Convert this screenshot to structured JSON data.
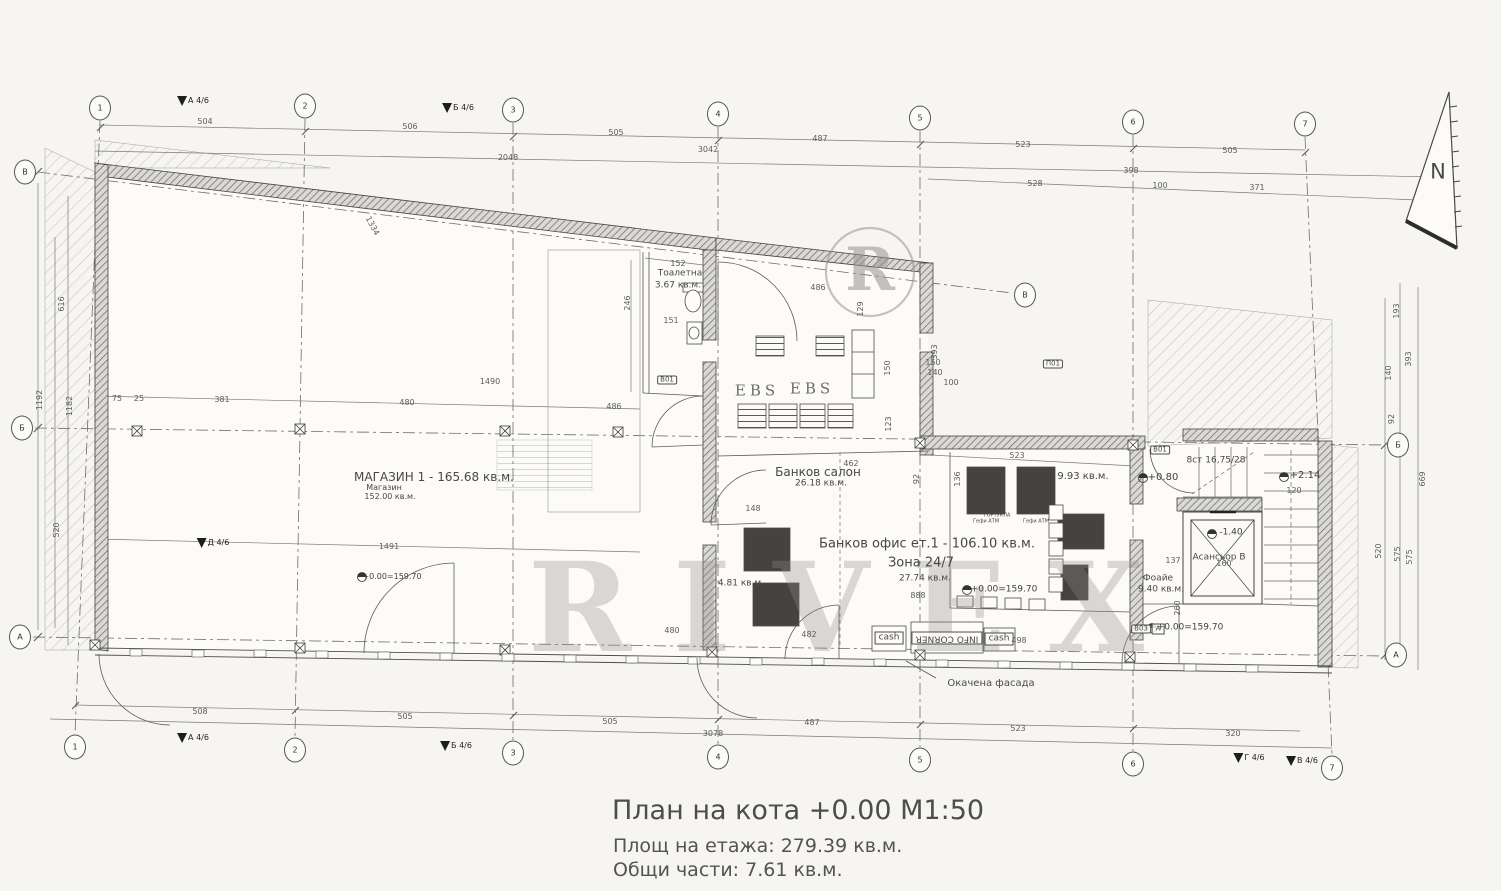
{
  "title": {
    "main": "План на кота +0.00 М1:50",
    "line1": "Площ на етажа: 279.39 кв.м.",
    "line2": "Общи части: 7.61 кв.м."
  },
  "watermark": {
    "big": "RIVEX",
    "circle": "R"
  },
  "colors": {
    "paper": "#f6f5f1",
    "ink": "#4a4a4a",
    "wall_fill": "#d9d7d1",
    "dark_block": "#454240",
    "watermark": "#8f8d87"
  },
  "grid": {
    "bubbles": [
      {
        "n": "grid-bubble-top-1",
        "t": "1",
        "x": 100,
        "y": 108
      },
      {
        "n": "grid-bubble-top-2",
        "t": "2",
        "x": 305,
        "y": 106
      },
      {
        "n": "grid-bubble-top-3",
        "t": "3",
        "x": 513,
        "y": 110
      },
      {
        "n": "grid-bubble-top-4",
        "t": "4",
        "x": 718,
        "y": 114
      },
      {
        "n": "grid-bubble-top-5",
        "t": "5",
        "x": 920,
        "y": 118
      },
      {
        "n": "grid-bubble-top-6",
        "t": "6",
        "x": 1133,
        "y": 122
      },
      {
        "n": "grid-bubble-top-7",
        "t": "7",
        "x": 1305,
        "y": 124
      },
      {
        "n": "grid-bubble-bottom-1",
        "t": "1",
        "x": 75,
        "y": 747
      },
      {
        "n": "grid-bubble-bottom-2",
        "t": "2",
        "x": 295,
        "y": 750
      },
      {
        "n": "grid-bubble-bottom-3",
        "t": "3",
        "x": 513,
        "y": 753
      },
      {
        "n": "grid-bubble-bottom-4",
        "t": "4",
        "x": 718,
        "y": 757
      },
      {
        "n": "grid-bubble-bottom-5",
        "t": "5",
        "x": 920,
        "y": 760
      },
      {
        "n": "grid-bubble-bottom-6",
        "t": "6",
        "x": 1133,
        "y": 764
      },
      {
        "n": "grid-bubble-bottom-7",
        "t": "7",
        "x": 1332,
        "y": 768
      },
      {
        "n": "grid-bubble-left-v",
        "t": "В",
        "x": 25,
        "y": 172
      },
      {
        "n": "grid-bubble-left-b",
        "t": "Б",
        "x": 22,
        "y": 428
      },
      {
        "n": "grid-bubble-left-a",
        "t": "А",
        "x": 20,
        "y": 637
      },
      {
        "n": "grid-bubble-right-b",
        "t": "Б",
        "x": 1398,
        "y": 445
      },
      {
        "n": "grid-bubble-right-a",
        "t": "А",
        "x": 1396,
        "y": 655
      },
      {
        "n": "grid-bubble-mid-v",
        "t": "В",
        "x": 1025,
        "y": 295
      }
    ],
    "flags": [
      {
        "n": "section-flag",
        "t": "А 4/6",
        "x": 193,
        "y": 101
      },
      {
        "n": "section-flag",
        "t": "Б 4/6",
        "x": 458,
        "y": 108
      },
      {
        "n": "section-flag",
        "t": "А 4/6",
        "x": 193,
        "y": 738
      },
      {
        "n": "section-flag",
        "t": "Б 4/6",
        "x": 456,
        "y": 746
      },
      {
        "n": "section-flag",
        "t": "Г 4/6",
        "x": 1249,
        "y": 758
      },
      {
        "n": "section-flag",
        "t": "В 4/6",
        "x": 1302,
        "y": 761
      },
      {
        "n": "section-flag",
        "t": "Д 4/6",
        "x": 213,
        "y": 543
      }
    ]
  },
  "rooms": [
    {
      "n": "room-label-shop",
      "t": "МАГАЗИН 1 - 165.68 кв.м.",
      "x": 434,
      "y": 477,
      "s": 12
    },
    {
      "n": "room-label-shop-sub",
      "t": "Магазин",
      "x": 384,
      "y": 488,
      "s": 8
    },
    {
      "n": "room-label-shop-area",
      "t": "152.00 кв.м.",
      "x": 390,
      "y": 497,
      "s": 8
    },
    {
      "n": "room-label-toilet",
      "t": "Тоалетна",
      "x": 680,
      "y": 274,
      "s": 9
    },
    {
      "n": "room-label-toilet-area",
      "t": "3.67 кв.м.",
      "x": 678,
      "y": 286,
      "s": 9
    },
    {
      "n": "room-label-bank-salon",
      "t": "Банков салон",
      "x": 818,
      "y": 472,
      "s": 12
    },
    {
      "n": "room-label-bank-salon-area",
      "t": "26.18 кв.м.",
      "x": 821,
      "y": 484,
      "s": 9
    },
    {
      "n": "room-label-bank-office",
      "t": "Банков офис ет.1 - 106.10 кв.м.",
      "x": 927,
      "y": 544,
      "s": 13
    },
    {
      "n": "room-label-zone-247",
      "t": "Зона 24/7",
      "x": 921,
      "y": 563,
      "s": 13
    },
    {
      "n": "room-label-zone-247-area",
      "t": "27.74 кв.м.",
      "x": 925,
      "y": 579,
      "s": 9
    },
    {
      "n": "room-label-atm-room-area",
      "t": "9.93 кв.м.",
      "x": 1083,
      "y": 477,
      "s": 10
    },
    {
      "n": "room-label-small-area",
      "t": "4.81 кв.м.",
      "x": 741,
      "y": 584,
      "s": 9
    },
    {
      "n": "room-label-foyer",
      "t": "Фоайе",
      "x": 1158,
      "y": 579,
      "s": 9
    },
    {
      "n": "room-label-foyer-area",
      "t": "9.40 кв.м.",
      "x": 1161,
      "y": 590,
      "s": 9
    },
    {
      "n": "room-label-elevator",
      "t": "Асансьор В",
      "x": 1219,
      "y": 558,
      "s": 9
    },
    {
      "n": "room-label-stairs",
      "t": "8ст 16,75/28",
      "x": 1216,
      "y": 461,
      "s": 9
    }
  ],
  "annotations": [
    {
      "n": "ebs-desk-label",
      "t": "EBS",
      "x": 757,
      "y": 391,
      "s": 15,
      "c": "ebs"
    },
    {
      "n": "ebs-desk-label",
      "t": "EBS",
      "x": 812,
      "y": 389,
      "s": 15,
      "c": "ebs"
    },
    {
      "n": "info-corner-label",
      "t": "INFO CORNER",
      "x": 947,
      "y": 638,
      "s": 9,
      "r": 180,
      "c": "boxed"
    },
    {
      "n": "cash-label",
      "t": "cash",
      "x": 889,
      "y": 638,
      "s": 9,
      "c": "boxed"
    },
    {
      "n": "cash-label",
      "t": "cash",
      "x": 999,
      "y": 639,
      "s": 9,
      "c": "boxed"
    },
    {
      "n": "facade-note",
      "t": "Окачена фасада",
      "x": 991,
      "y": 684,
      "s": 10
    },
    {
      "n": "tiny-note",
      "t": "ГОРТУКЛА",
      "x": 997,
      "y": 516,
      "s": 5
    },
    {
      "n": "tiny-note",
      "t": "Гефи АТМ",
      "x": 986,
      "y": 522,
      "s": 5
    },
    {
      "n": "tiny-note",
      "t": "Гефи АТМ",
      "x": 1036,
      "y": 522,
      "s": 5
    },
    {
      "n": "marker-id",
      "t": "В01",
      "x": 667,
      "y": 380,
      "s": 7,
      "c": "hexed"
    },
    {
      "n": "marker-id",
      "t": "В01",
      "x": 1160,
      "y": 450,
      "s": 7,
      "c": "hexed"
    },
    {
      "n": "marker-id",
      "t": "В03",
      "x": 1141,
      "y": 629,
      "s": 7,
      "c": "hexed"
    },
    {
      "n": "marker-id",
      "t": "П01",
      "x": 1053,
      "y": 364,
      "s": 7,
      "c": "hexed"
    },
    {
      "n": "marker-id",
      "t": "А",
      "x": 1158,
      "y": 629,
      "s": 7,
      "c": "boxed"
    },
    {
      "n": "north-label",
      "t": "N",
      "x": 1438,
      "y": 172,
      "s": 21
    }
  ],
  "levels": [
    {
      "n": "level-mark",
      "t": "+0.80",
      "x": 1163,
      "y": 478,
      "s": 10
    },
    {
      "n": "level-mark",
      "t": "+2.14",
      "x": 1305,
      "y": 476,
      "s": 10
    },
    {
      "n": "level-mark",
      "t": "-1.40",
      "x": 1231,
      "y": 533,
      "s": 9
    },
    {
      "n": "level-mark",
      "t": "+0.00=159.70",
      "x": 392,
      "y": 577,
      "s": 8
    },
    {
      "n": "level-mark",
      "t": "+0.00=159.70",
      "x": 1004,
      "y": 590,
      "s": 9
    },
    {
      "n": "level-mark",
      "t": "+0.00=159.70",
      "x": 1190,
      "y": 628,
      "s": 9
    }
  ],
  "dimensions": {
    "top": [
      {
        "t": "504",
        "x": 205,
        "y": 122
      },
      {
        "t": "506",
        "x": 410,
        "y": 127
      },
      {
        "t": "505",
        "x": 616,
        "y": 133
      },
      {
        "t": "487",
        "x": 820,
        "y": 139
      },
      {
        "t": "523",
        "x": 1023,
        "y": 145
      },
      {
        "t": "505",
        "x": 1230,
        "y": 151
      },
      {
        "t": "2048",
        "x": 508,
        "y": 158
      },
      {
        "t": "3042",
        "x": 708,
        "y": 150
      },
      {
        "t": "398",
        "x": 1131,
        "y": 171
      },
      {
        "t": "528",
        "x": 1035,
        "y": 184
      },
      {
        "t": "100",
        "x": 1160,
        "y": 186
      },
      {
        "t": "371",
        "x": 1257,
        "y": 188
      }
    ],
    "bottom": [
      {
        "t": "508",
        "x": 200,
        "y": 712
      },
      {
        "t": "505",
        "x": 405,
        "y": 717
      },
      {
        "t": "505",
        "x": 610,
        "y": 722
      },
      {
        "t": "3078",
        "x": 713,
        "y": 734
      },
      {
        "t": "487",
        "x": 812,
        "y": 723
      },
      {
        "t": "523",
        "x": 1018,
        "y": 729
      },
      {
        "t": "320",
        "x": 1233,
        "y": 734
      }
    ],
    "left": [
      {
        "t": "1192",
        "x": 40,
        "y": 400,
        "r": -90
      },
      {
        "t": "616",
        "x": 62,
        "y": 304,
        "r": -90
      },
      {
        "t": "1182",
        "x": 70,
        "y": 406,
        "r": -90
      },
      {
        "t": "520",
        "x": 57,
        "y": 530,
        "r": -90
      }
    ],
    "right": [
      {
        "t": "193",
        "x": 1397,
        "y": 311,
        "r": -90
      },
      {
        "t": "140",
        "x": 1389,
        "y": 373,
        "r": -90
      },
      {
        "t": "92",
        "x": 1392,
        "y": 419,
        "r": -90
      },
      {
        "t": "393",
        "x": 1409,
        "y": 359,
        "r": -90
      },
      {
        "t": "669",
        "x": 1423,
        "y": 479,
        "r": -90
      },
      {
        "t": "520",
        "x": 1379,
        "y": 551,
        "r": -90
      },
      {
        "t": "575",
        "x": 1398,
        "y": 554,
        "r": -90
      },
      {
        "t": "575",
        "x": 1410,
        "y": 557,
        "r": -90
      }
    ],
    "interior": [
      {
        "t": "75",
        "x": 117,
        "y": 399
      },
      {
        "t": "25",
        "x": 139,
        "y": 399
      },
      {
        "t": "381",
        "x": 222,
        "y": 400
      },
      {
        "t": "480",
        "x": 407,
        "y": 403
      },
      {
        "t": "486",
        "x": 614,
        "y": 407
      },
      {
        "t": "1490",
        "x": 490,
        "y": 382
      },
      {
        "t": "1491",
        "x": 389,
        "y": 547
      },
      {
        "t": "1334",
        "x": 372,
        "y": 226,
        "r": 62
      },
      {
        "t": "152",
        "x": 678,
        "y": 264
      },
      {
        "t": "151",
        "x": 671,
        "y": 321
      },
      {
        "t": "246",
        "x": 628,
        "y": 303,
        "r": -90
      },
      {
        "t": "486",
        "x": 818,
        "y": 288
      },
      {
        "t": "129",
        "x": 861,
        "y": 309,
        "r": -90
      },
      {
        "t": "462",
        "x": 851,
        "y": 464
      },
      {
        "t": "148",
        "x": 753,
        "y": 509
      },
      {
        "t": "92",
        "x": 917,
        "y": 479,
        "r": -90
      },
      {
        "t": "393",
        "x": 935,
        "y": 352,
        "r": -90
      },
      {
        "t": "150",
        "x": 933,
        "y": 363
      },
      {
        "t": "140",
        "x": 935,
        "y": 373
      },
      {
        "t": "100",
        "x": 951,
        "y": 383
      },
      {
        "t": "150",
        "x": 888,
        "y": 368,
        "r": -90
      },
      {
        "t": "123",
        "x": 889,
        "y": 424,
        "r": -90
      },
      {
        "t": "523",
        "x": 1017,
        "y": 456
      },
      {
        "t": "136",
        "x": 958,
        "y": 479,
        "r": -90
      },
      {
        "t": "498",
        "x": 1019,
        "y": 641
      },
      {
        "t": "480",
        "x": 672,
        "y": 631
      },
      {
        "t": "482",
        "x": 809,
        "y": 635
      },
      {
        "t": "888",
        "x": 918,
        "y": 596
      },
      {
        "t": "137",
        "x": 1173,
        "y": 561
      },
      {
        "t": "160",
        "x": 1224,
        "y": 564
      },
      {
        "t": "120",
        "x": 1294,
        "y": 491
      },
      {
        "t": "260",
        "x": 1178,
        "y": 608,
        "r": -90
      }
    ]
  }
}
